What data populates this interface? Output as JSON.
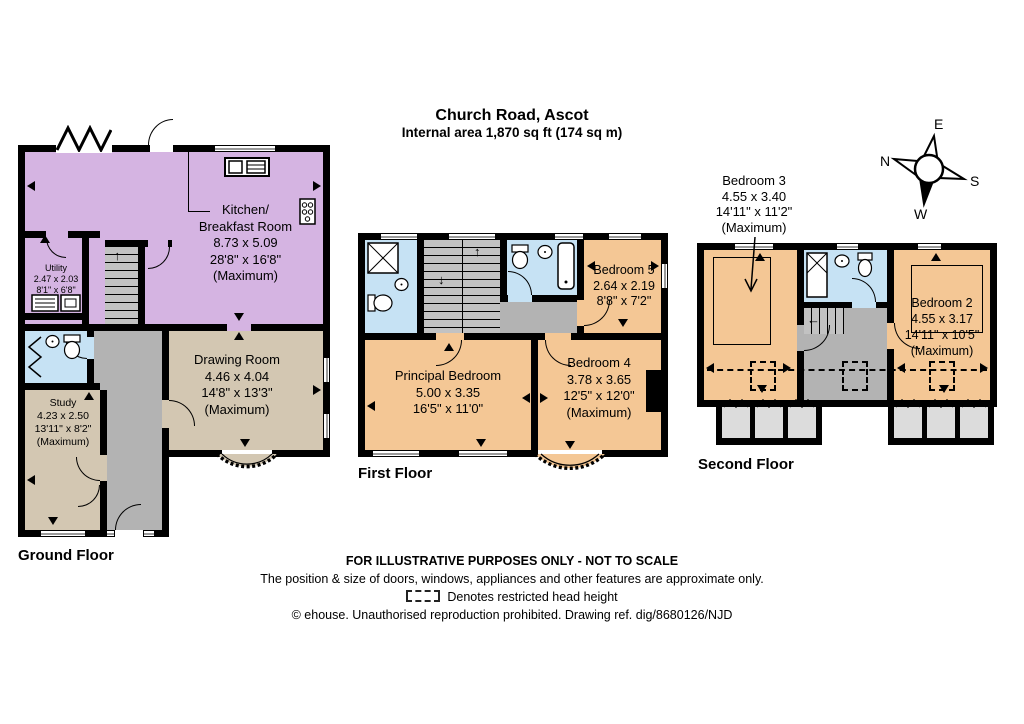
{
  "title": {
    "line1": "Church Road, Ascot",
    "line2": "Internal area 1,870 sq ft (174 sq m)"
  },
  "compass": {
    "e": "E",
    "s": "S",
    "w": "W",
    "n": "N"
  },
  "floors": {
    "ground": {
      "label": "Ground Floor",
      "rooms": {
        "kitchen": {
          "name1": "Kitchen/",
          "name2": "Breakfast Room",
          "metric": "8.73 x 5.09",
          "imperial": "28'8\" x 16'8\"",
          "max": "(Maximum)"
        },
        "utility": {
          "name": "Utility",
          "metric": "2.47 x 2.03",
          "imperial": "8'1\" x 6'8\""
        },
        "drawing": {
          "name": "Drawing Room",
          "metric": "4.46 x 4.04",
          "imperial": "14'8\" x 13'3\"",
          "max": "(Maximum)"
        },
        "study": {
          "name": "Study",
          "metric": "4.23 x 2.50",
          "imperial": "13'11\" x 8'2\"",
          "max": "(Maximum)"
        }
      }
    },
    "first": {
      "label": "First Floor",
      "rooms": {
        "principal": {
          "name": "Principal Bedroom",
          "metric": "5.00 x 3.35",
          "imperial": "16'5\" x 11'0\""
        },
        "bedroom4": {
          "name": "Bedroom 4",
          "metric": "3.78 x 3.65",
          "imperial": "12'5\" x 12'0\"",
          "max": "(Maximum)"
        },
        "bedroom5": {
          "name": "Bedroom 5",
          "metric": "2.64 x 2.19",
          "imperial": "8'8\" x 7'2\""
        }
      }
    },
    "second": {
      "label": "Second Floor",
      "rooms": {
        "bedroom3": {
          "name": "Bedroom 3",
          "metric": "4.55 x 3.40",
          "imperial": "14'11\" x 11'2\"",
          "max": "(Maximum)"
        },
        "bedroom2": {
          "name": "Bedroom 2",
          "metric": "4.55 x 3.17",
          "imperial": "14'11\" x 10'5\"",
          "max": "(Maximum)"
        }
      }
    }
  },
  "footer": {
    "line1": "FOR ILLUSTRATIVE PURPOSES ONLY - NOT TO SCALE",
    "line2": "The position & size of doors, windows, appliances and other features are approximate only.",
    "line3": "Denotes restricted head height",
    "line4": "© ehouse. Unauthorised reproduction prohibited. Drawing ref. dig/8680126/NJD"
  },
  "colors": {
    "kitchen_purple": "#d5b4e2",
    "reception_tan": "#d3c7b2",
    "bedroom_orange": "#f4c795",
    "bathroom_blue": "#c6e2f4",
    "circulation_grey": "#b3b3b3",
    "dormer_grey": "#dcdcdc",
    "wall_black": "#000000"
  }
}
